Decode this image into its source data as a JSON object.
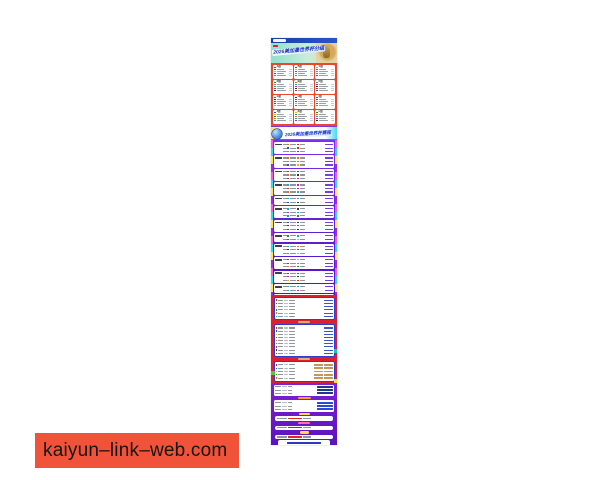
{
  "watermark": {
    "text": "kaiyun–link–web.com",
    "bg": "#f0523a"
  },
  "poster": {
    "alt": "2026-world-cup-schedule-poster",
    "hero": {
      "title": "2026美加墨世界杯分组"
    },
    "groups": {
      "labels": [
        "A组",
        "B组",
        "C组",
        "D组",
        "E组",
        "F组",
        "G组",
        "H组",
        "I组",
        "J组",
        "K组",
        "L组"
      ],
      "teams_per_group": 4,
      "bg": "#e8492e",
      "flag_palette": [
        "#d22c20",
        "#2756c8",
        "#f5b400",
        "#2c8a2c",
        "#e87010",
        "#10a8c8",
        "#b02cb0",
        "#333333"
      ]
    },
    "schedule": {
      "title": "2026美加墨世界杯赛程",
      "bg_top": "#7b2ff0",
      "bg_bottom": "#4c14c4",
      "panel_rows": [
        3,
        3,
        3,
        3,
        2,
        3,
        3,
        2,
        3,
        3,
        3,
        2,
        3
      ],
      "venue_color": "#7a3ae0"
    },
    "knockout": {
      "bg": "#de1f2e",
      "panels": [
        {
          "rows": 6,
          "tan": false
        },
        {
          "rows": 9,
          "tan": false
        },
        {
          "rows": 5,
          "tan": true
        }
      ],
      "corner_accents": [
        {
          "side": "right",
          "top": 54,
          "color": "#18c8b0"
        },
        {
          "side": "left",
          "top": 76,
          "color": "#58c828"
        },
        {
          "side": "right",
          "top": 84,
          "color": "#ffd84a"
        }
      ]
    },
    "bottom": {
      "items": [
        {
          "t": "panel",
          "rows": 3,
          "right": "#22368e"
        },
        {
          "t": "pill",
          "c": "#ff9a2a",
          "w": 13
        },
        {
          "t": "panel",
          "rows": 3,
          "right": "#2a4ad0"
        },
        {
          "t": "pill",
          "c": "#ffd84a",
          "w": 11
        },
        {
          "t": "bar",
          "accent": "#e02424"
        },
        {
          "t": "pill",
          "c": "#ff6ac0",
          "w": 12
        },
        {
          "t": "bar",
          "accent": "#2a4ad0"
        },
        {
          "t": "pill",
          "c": "#ffd84a",
          "w": 9
        },
        {
          "t": "bar",
          "accent": "#e02424"
        },
        {
          "t": "footer",
          "line_colors": [
            "#2a3ac0",
            "#d02020",
            "#2a3ac0"
          ]
        }
      ],
      "tiny_line_widths": [
        30,
        20
      ]
    }
  }
}
